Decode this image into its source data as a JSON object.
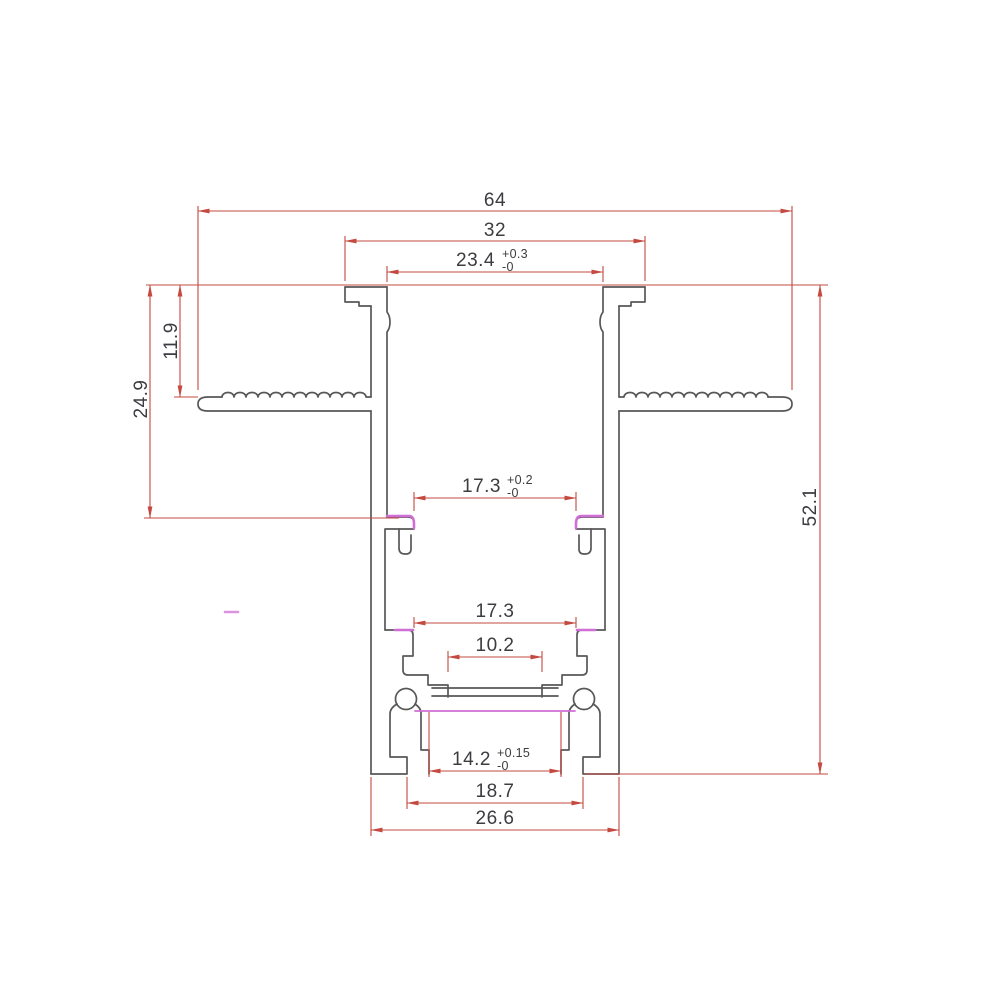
{
  "drawing": {
    "type": "technical-cross-section",
    "subject": "recessed-aluminum-profile"
  },
  "colors": {
    "background": "#ffffff",
    "outline_gray": "#575757",
    "dimension_red": "#c4493f",
    "highlight_magenta": "#cf6fd6",
    "text_dark": "#3c3c41"
  },
  "dims": {
    "top_width": "64",
    "hook_span": "32",
    "top_opening": "23.4",
    "top_opening_tol_plus": "+0.3",
    "top_opening_tol_minus": "-0",
    "wing_depth": "11.9",
    "ledge_depth": "24.9",
    "overall_height": "52.1",
    "ledge_opening": "17.3",
    "ledge_opening_tol_plus": "+0.2",
    "ledge_opening_tol_minus": "-0",
    "lower_opening": "17.3",
    "shelf_opening": "10.2",
    "diffuser_opening": "14.2",
    "diffuser_opening_tol_plus": "+0.15",
    "diffuser_opening_tol_minus": "-0",
    "base_step_width": "18.7",
    "base_width": "26.6"
  }
}
